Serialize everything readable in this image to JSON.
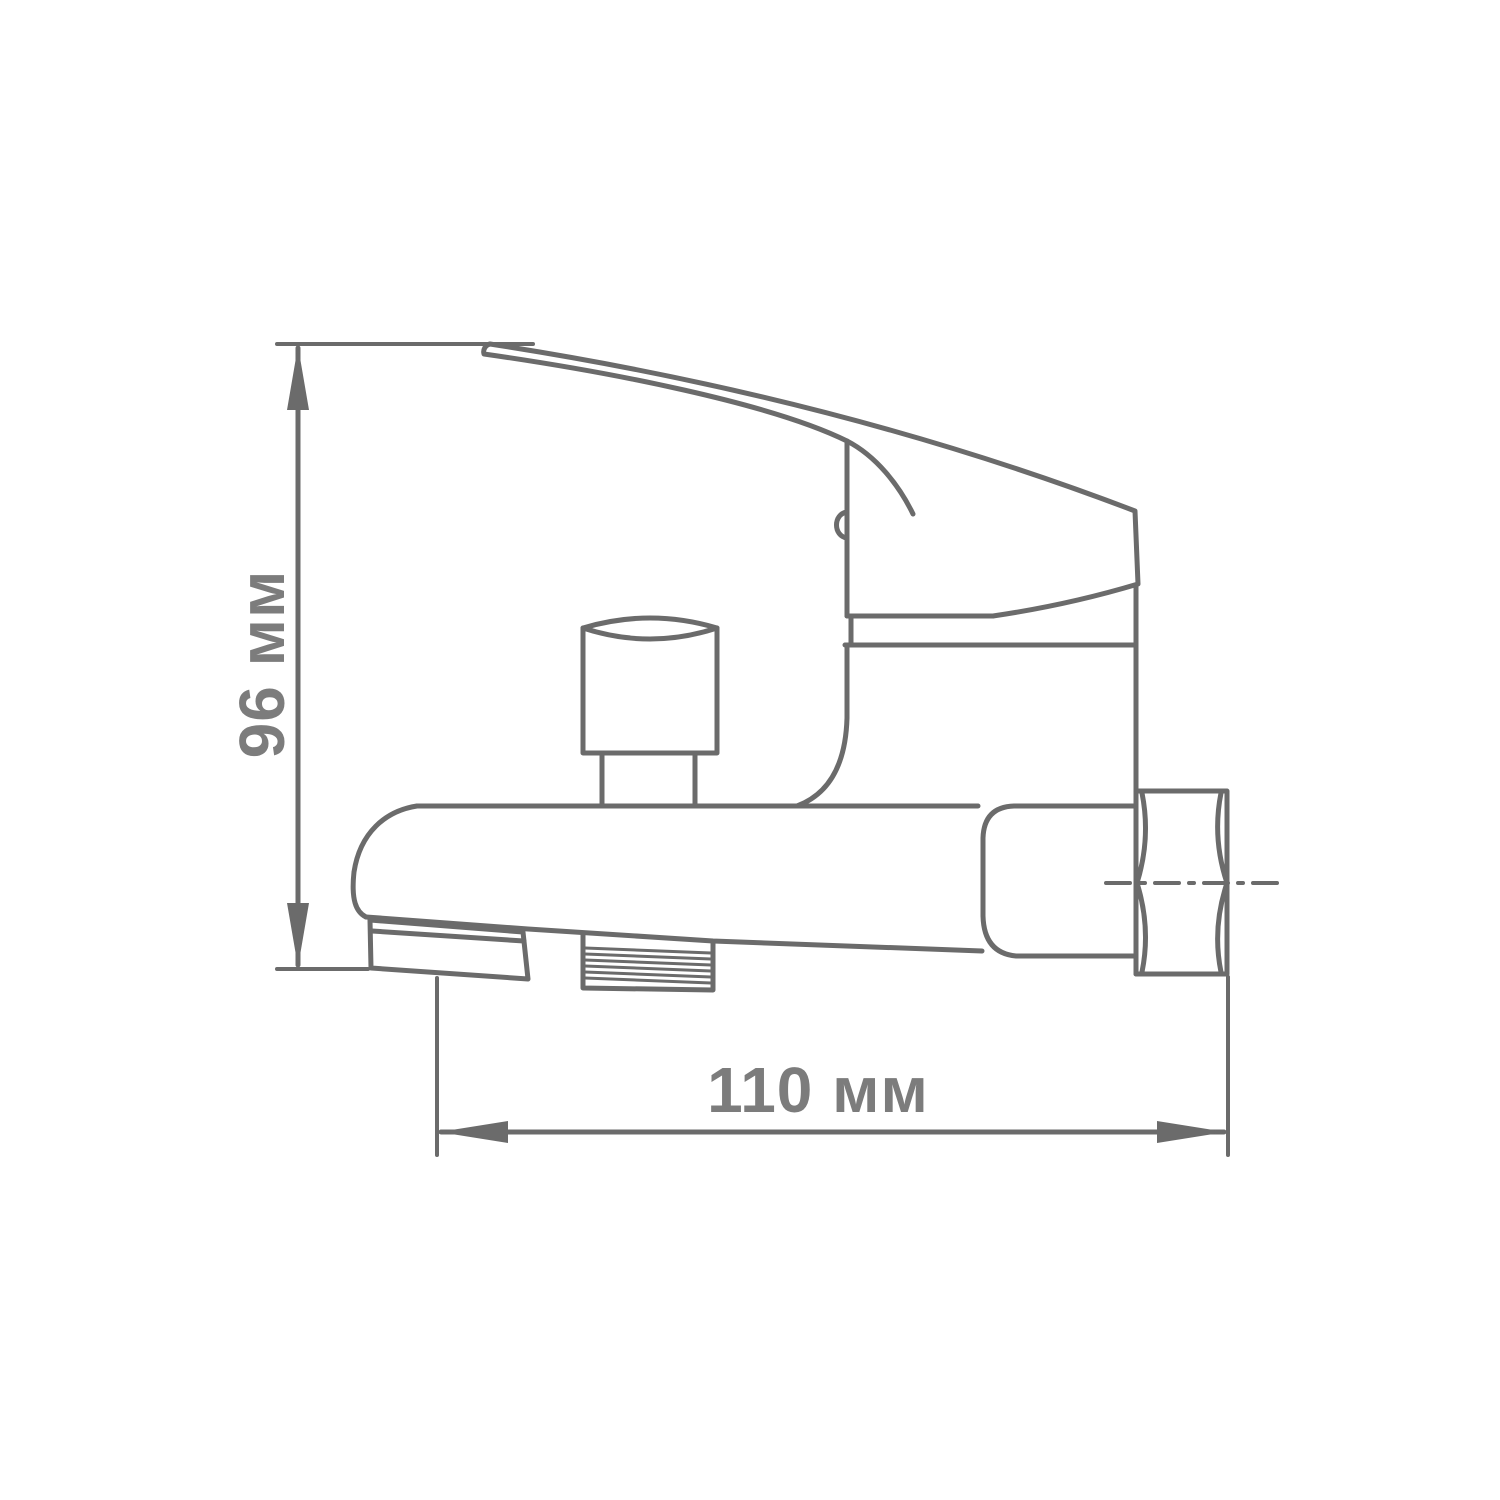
{
  "page": {
    "background": "#ffffff"
  },
  "drawing": {
    "kind": "technical-dimension-drawing",
    "subject": "Wall-mounted single-lever bath mixer faucet, side view",
    "colors": {
      "line": "#6b6b6b",
      "label": "#7c7c7c",
      "background": "#ffffff"
    },
    "labels": {
      "height": "96 мм",
      "width": "110 мм"
    },
    "parts": [
      "lever-handle",
      "mixer-body",
      "cartridge-cap-ring",
      "diverter-knob",
      "spout",
      "spout-tip",
      "shower-hose-thread",
      "wall-mount-nut",
      "centerline"
    ]
  }
}
